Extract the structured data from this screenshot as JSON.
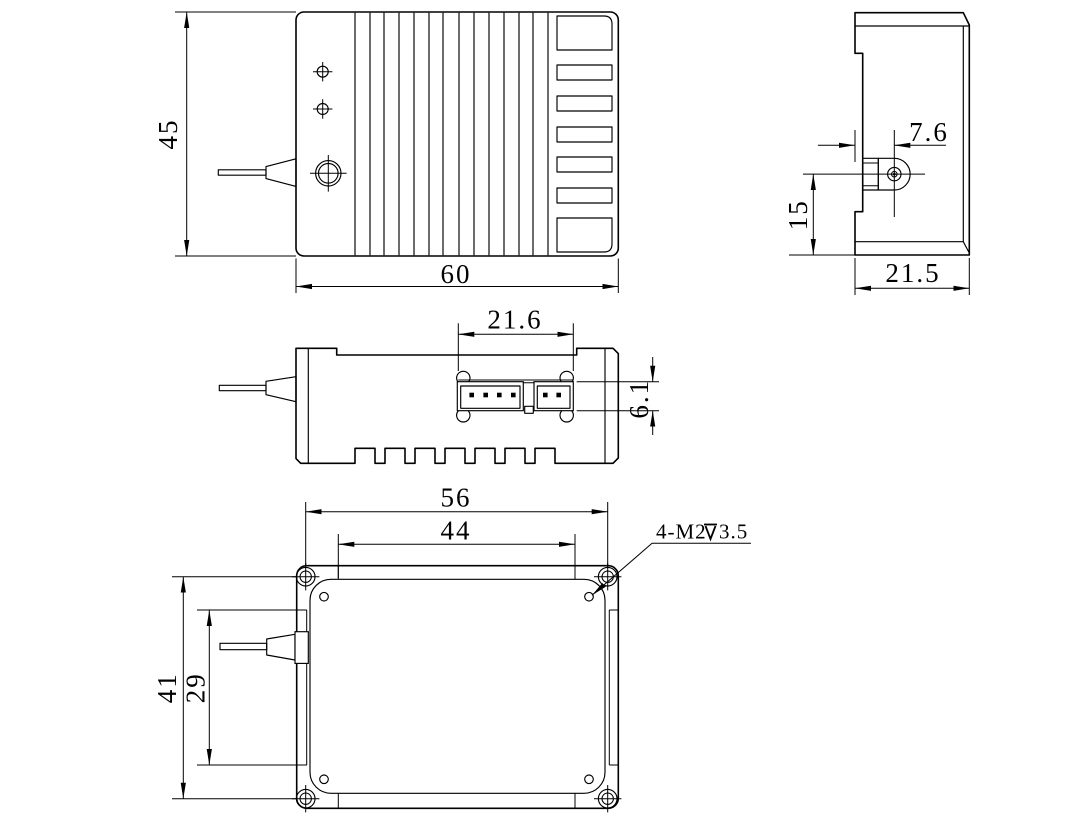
{
  "drawing": {
    "background_color": "#ffffff",
    "line_color": "#000000",
    "dims": {
      "front_height": "45",
      "front_width": "60",
      "side_fiber_offset": "7.6",
      "side_fiber_height": "15",
      "side_depth": "21.5",
      "top_connector_span": "21.6",
      "top_connector_depth": "6.1",
      "bottom_screw_span_x": "56",
      "bottom_hole_span_x": "44",
      "bottom_screw_span_y": "41",
      "bottom_hole_span_y": "29"
    },
    "callout": {
      "thread": "4-M2",
      "depth_symbol": "⊻",
      "depth": "3.5"
    }
  }
}
